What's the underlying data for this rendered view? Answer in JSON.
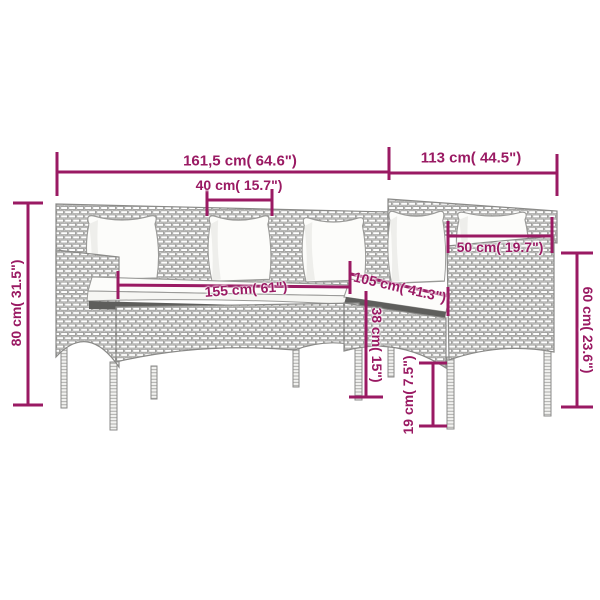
{
  "colors": {
    "accent": "#9A1A63",
    "sketch_stroke": "#9A9A98",
    "cushion_fill": "#FBFBF8",
    "seat_shadow": "#5E5E5C",
    "background": "#FFFFFF"
  },
  "measurements": [
    {
      "name": "overall-width",
      "cm": 161.5,
      "inches": 64.6,
      "label": "161,5 cm( 64.6\")"
    },
    {
      "name": "overall-depth",
      "cm": 113,
      "inches": 44.5,
      "label": "113 cm( 44.5\")"
    },
    {
      "name": "back-cushion-width",
      "cm": 40,
      "inches": 15.7,
      "label": "40 cm( 15.7\")"
    },
    {
      "name": "overall-height",
      "cm": 80,
      "inches": 31.5,
      "label": "80 cm( 31.5\")"
    },
    {
      "name": "seat-width",
      "cm": 155,
      "inches": 61,
      "label": "155 cm( 61\")"
    },
    {
      "name": "chaise-seat-length",
      "cm": 105,
      "inches": 41.3,
      "label": "105 cm( 41.3\")"
    },
    {
      "name": "end-section-width",
      "cm": 50,
      "inches": 19.7,
      "label": "50 cm( 19.7\")"
    },
    {
      "name": "side-height",
      "cm": 60,
      "inches": 23.6,
      "label": "60 cm( 23.6\")"
    },
    {
      "name": "seat-height",
      "cm": 38,
      "inches": 15,
      "label": "38 cm( 15\")"
    },
    {
      "name": "leg-height",
      "cm": 19,
      "inches": 7.5,
      "label": "19 cm( 7.5\")"
    }
  ]
}
